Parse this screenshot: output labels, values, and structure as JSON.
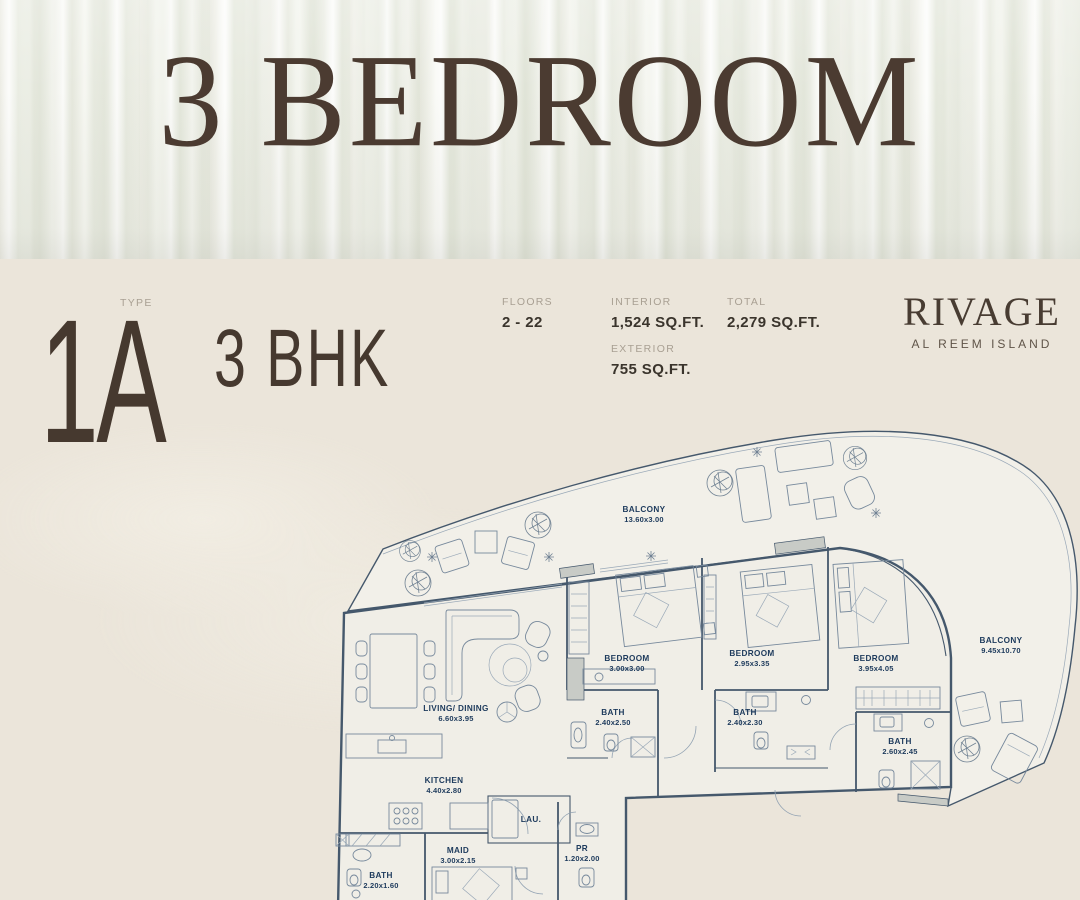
{
  "colors": {
    "background": "#ebe5da",
    "accent": "#4b3b31",
    "plan_line": "#45586c",
    "plan_label": "#1d3a5c"
  },
  "hero": {
    "title": "3 BEDROOM"
  },
  "unit": {
    "type_label": "TYPE",
    "type_value": "1A",
    "layout": "3 BHK"
  },
  "stats": {
    "floors": {
      "label": "FLOORS",
      "value": "2 - 22"
    },
    "interior": {
      "label": "INTERIOR",
      "value": "1,524 SQ.FT."
    },
    "exterior": {
      "label": "EXTERIOR",
      "value": "755 SQ.FT."
    },
    "total": {
      "label": "TOTAL",
      "value": "2,279 SQ.FT."
    }
  },
  "brand": {
    "name": "RIVAGE",
    "location": "AL REEM ISLAND"
  },
  "floorplan": {
    "rooms": [
      {
        "name": "BALCONY",
        "dims": "13.60x3.00"
      },
      {
        "name": "BALCONY",
        "dims": "9.45x10.70"
      },
      {
        "name": "LIVING/ DINING",
        "dims": "6.60x3.95"
      },
      {
        "name": "KITCHEN",
        "dims": "4.40x2.80"
      },
      {
        "name": "LAU.",
        "dims": ""
      },
      {
        "name": "MAID",
        "dims": "3.00x2.15"
      },
      {
        "name": "PR",
        "dims": "1.20x2.00"
      },
      {
        "name": "BATH",
        "dims": "2.20x1.60"
      },
      {
        "name": "BEDROOM",
        "dims": "3.00x3.00"
      },
      {
        "name": "BATH",
        "dims": "2.40x2.50"
      },
      {
        "name": "BEDROOM",
        "dims": "2.95x3.35"
      },
      {
        "name": "BATH",
        "dims": "2.40x2.30"
      },
      {
        "name": "BEDROOM",
        "dims": "3.95x4.05"
      },
      {
        "name": "BATH",
        "dims": "2.60x2.45"
      }
    ]
  }
}
